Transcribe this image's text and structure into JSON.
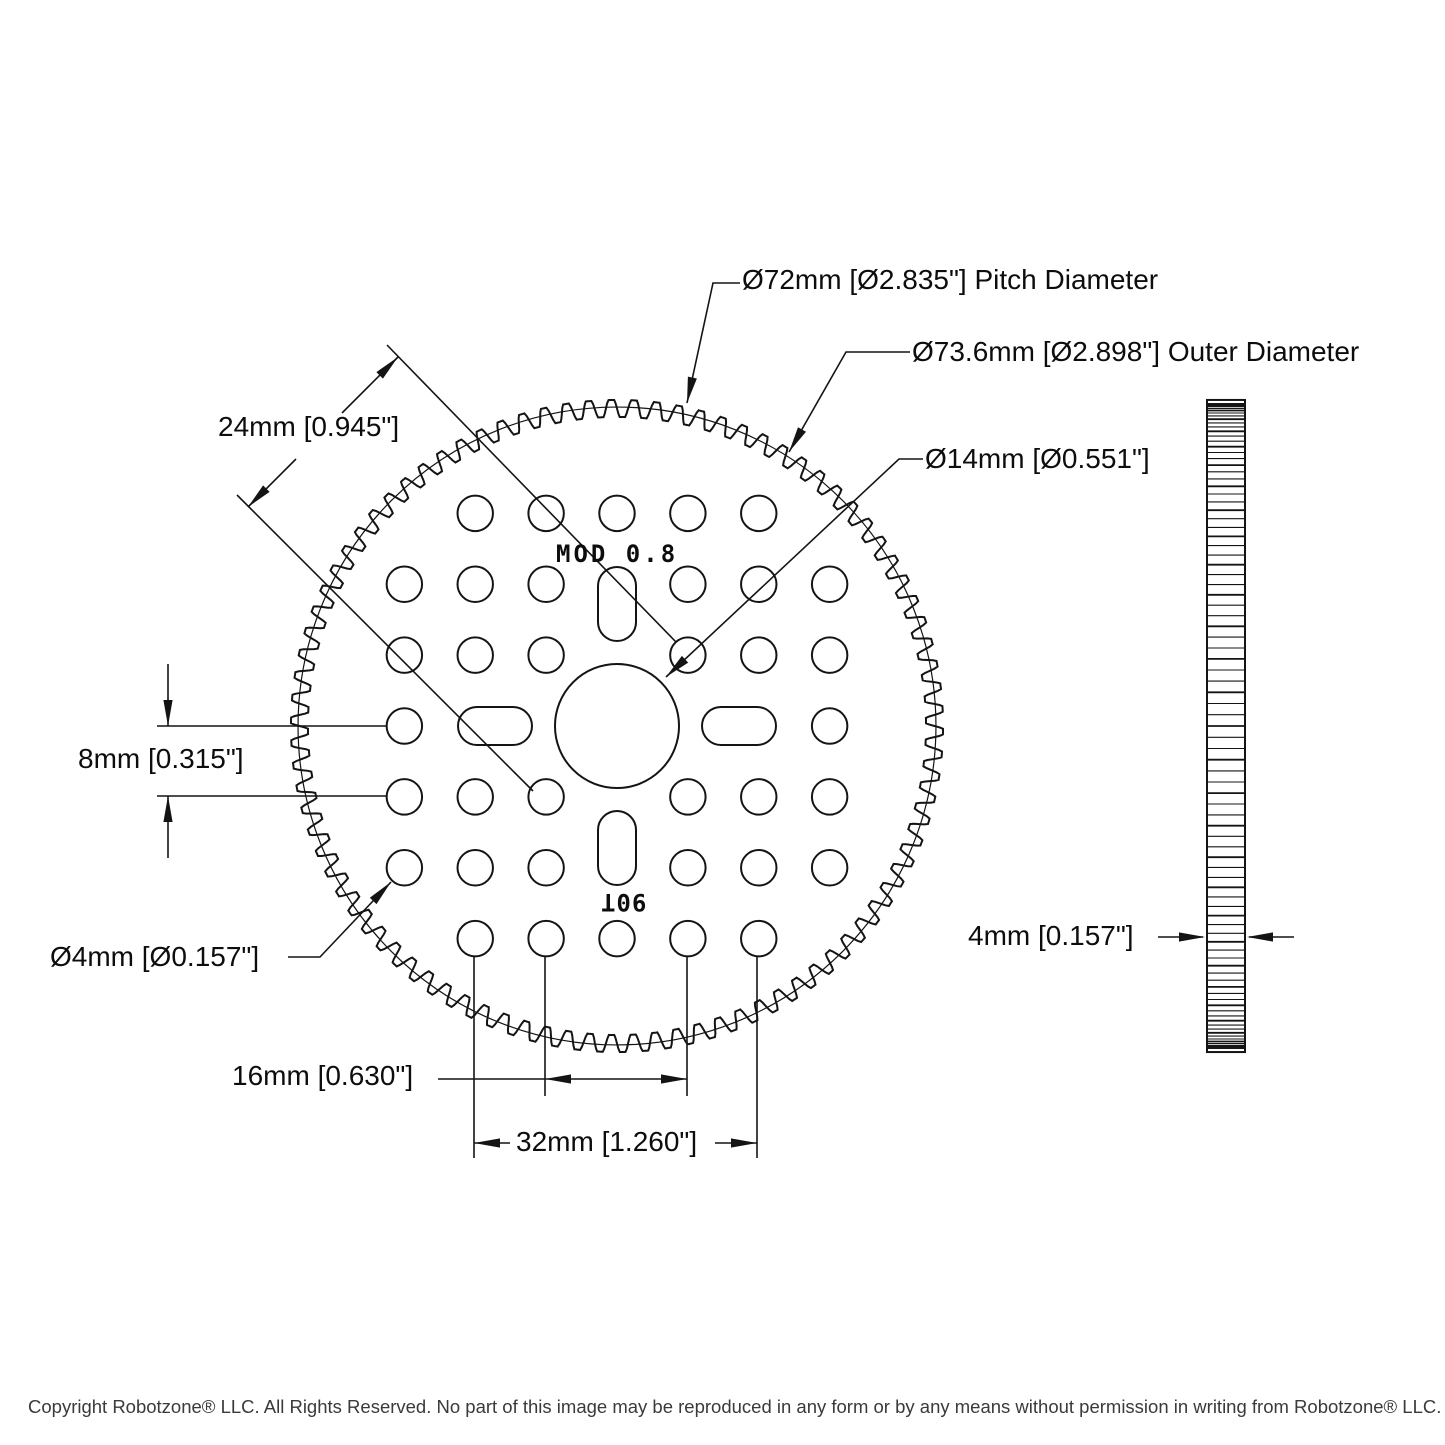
{
  "drawing": {
    "gear": {
      "teeth": 90,
      "module": 0.8,
      "pitch_diameter_mm": 72,
      "outer_diameter_mm": 73.6,
      "bore_diameter_mm": 14,
      "hole_diameter_mm": 4,
      "hole_spacing_mm": 8,
      "thickness_mm": 4
    },
    "labels": {
      "pitch_diameter": "Ø72mm [Ø2.835\"] Pitch Diameter",
      "outer_diameter": "Ø73.6mm [Ø2.898\"] Outer Diameter",
      "bore_diameter": "Ø14mm [Ø0.551\"]",
      "diagonal_spacing": "24mm [0.945\"]",
      "row_spacing": "8mm [0.315\"]",
      "hole_diameter": "Ø4mm [Ø0.157\"]",
      "hole_span_16": "16mm [0.630\"]",
      "hole_span_32": "32mm [1.260\"]",
      "thickness": "4mm [0.157\"]",
      "module_marking": "MOD 0.8",
      "tooth_count_marking": "90T"
    },
    "footer": {
      "copyright": "Copyright Robotzone® LLC.  All Rights Reserved. No part of this image may be reproduced in any form or by any means without permission in writing from Robotzone® LLC."
    }
  }
}
